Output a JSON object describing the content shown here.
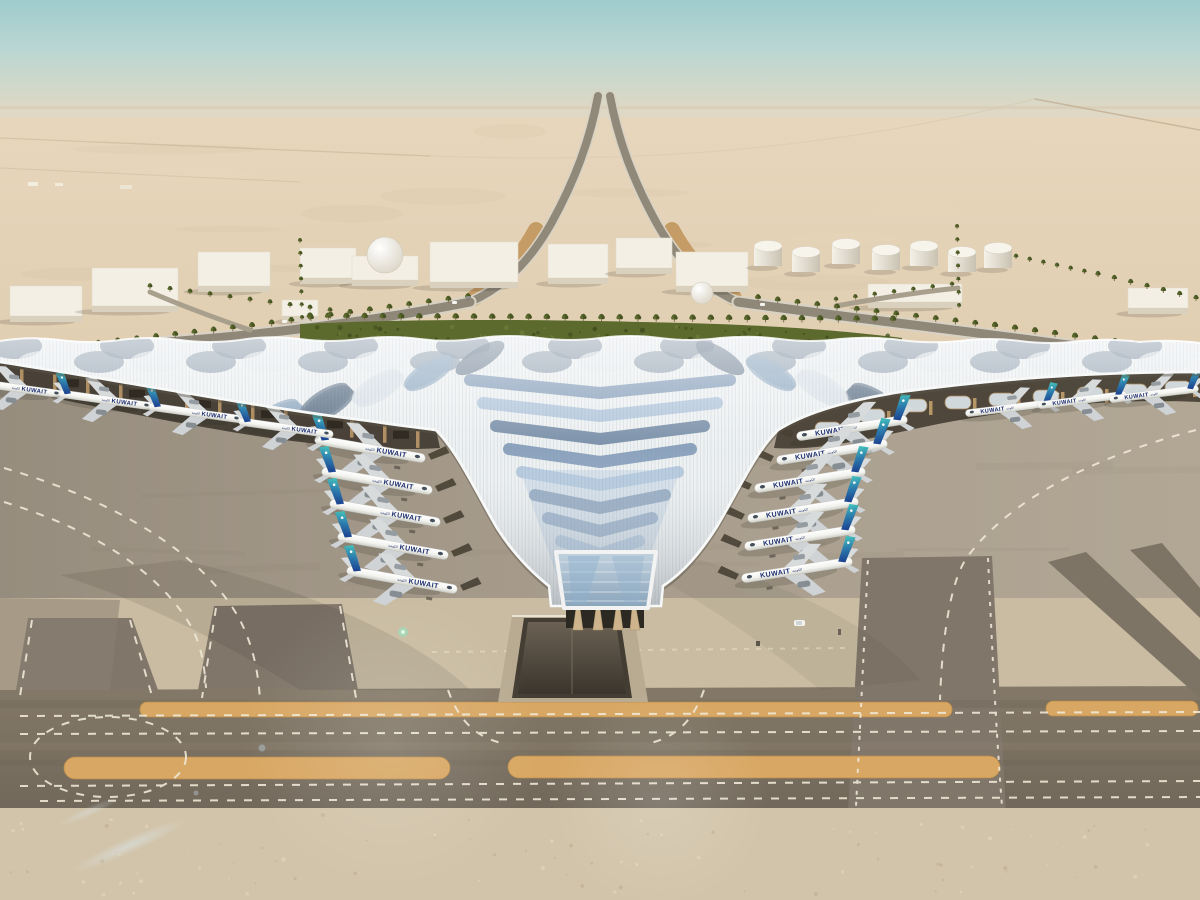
{
  "scene": {
    "subject": "aerial-rendering-airport-terminal",
    "livery": {
      "text": "KUWAIT",
      "arabic": "الكويتية"
    }
  },
  "colors": {
    "sky_top": "#9fcbce",
    "sky_mid": "#c2dad4",
    "sky_horizon": "#e7d8c2",
    "desert_far": "#e5d4ba",
    "desert_near": "#d6c3a4",
    "sand_pale": "#c9bca2",
    "sand_bottom": "#d2c4aa",
    "asphalt": "#7d7263",
    "apron": "#a89d8d",
    "tan_strip": "#d8a763",
    "marking": "#efe8d6",
    "roof_white": "#eef1f2",
    "roof_slate": "#5d7286",
    "roof_blue": "#7390b0",
    "roof_blue_light": "#a6bfd8",
    "under_canopy": "#3e372d",
    "column_tan": "#c8a36e",
    "arch_glass": "#dfe8ee",
    "green": "#5c6a2e",
    "green_dark": "#46521f",
    "palm": "#4e5c28",
    "trunk": "#7a6a4a",
    "plane_white": "#f4f4f0",
    "plane_grey": "#d8dbdc",
    "engine": "#969da2",
    "tail_teal": "#46c4bc",
    "tail_mid": "#2d7fae",
    "tail_blue": "#1c3e8e",
    "livery_navy": "#1d2f70",
    "building_roof": "#f3efe4",
    "building_front": "#d9d0bd",
    "road": "#90897a",
    "road_light": "#d8d2c5",
    "trench_tan": "#c69c66",
    "shadow": "#3a342a"
  },
  "aircraft": {
    "left_column": {
      "dir": 1,
      "rot": 10,
      "s": 1.0,
      "bridge": true,
      "pts": [
        [
          370,
          449
        ],
        [
          377,
          481
        ],
        [
          385,
          513
        ],
        [
          393,
          546
        ],
        [
          402,
          580
        ]
      ]
    },
    "left_wing": {
      "dir": 1,
      "rot": 8,
      "s": 0.85,
      "bridge": false,
      "pts": [
        [
          16,
          388
        ],
        [
          106,
          400
        ],
        [
          196,
          413
        ],
        [
          286,
          428
        ]
      ]
    },
    "right_column": {
      "dir": -1,
      "rot": -9,
      "s": 1.0,
      "bridge": true,
      "pts": [
        [
          852,
          428
        ],
        [
          832,
          452
        ],
        [
          810,
          480
        ],
        [
          803,
          510
        ],
        [
          800,
          538
        ],
        [
          797,
          570
        ]
      ]
    },
    "right_wing": {
      "dir": -1,
      "rot": -7,
      "s": 0.8,
      "bridge": false,
      "pts": [
        [
          1010,
          408
        ],
        [
          1082,
          400
        ],
        [
          1154,
          394
        ]
      ]
    }
  },
  "fuel_tanks": [
    [
      768,
      246
    ],
    [
      806,
      252
    ],
    [
      846,
      244
    ],
    [
      886,
      250
    ],
    [
      924,
      246
    ],
    [
      962,
      252
    ],
    [
      998,
      248
    ]
  ],
  "buildings": [
    {
      "x": 10,
      "y": 286,
      "w": 72,
      "h": 30
    },
    {
      "x": 92,
      "y": 268,
      "w": 86,
      "h": 38
    },
    {
      "x": 198,
      "y": 252,
      "w": 72,
      "h": 34
    },
    {
      "x": 282,
      "y": 300,
      "w": 36,
      "h": 16
    },
    {
      "x": 300,
      "y": 248,
      "w": 56,
      "h": 30
    },
    {
      "x": 352,
      "y": 256,
      "w": 66,
      "h": 24,
      "dome": [
        385,
        255,
        18
      ]
    },
    {
      "x": 430,
      "y": 242,
      "w": 88,
      "h": 40
    },
    {
      "x": 548,
      "y": 244,
      "w": 60,
      "h": 34
    },
    {
      "x": 616,
      "y": 238,
      "w": 56,
      "h": 30
    },
    {
      "x": 676,
      "y": 252,
      "w": 72,
      "h": 34,
      "dome": [
        702,
        293,
        11
      ]
    },
    {
      "x": 868,
      "y": 284,
      "w": 94,
      "h": 18
    },
    {
      "x": 1128,
      "y": 288,
      "w": 60,
      "h": 20
    }
  ],
  "palm_rows": [
    {
      "x1": 310,
      "y1": 320,
      "x2": 893,
      "y2": 323,
      "n": 33,
      "s": 1.0
    },
    {
      "x1": 468,
      "y1": 300,
      "x2": 252,
      "y2": 329,
      "n": 12,
      "s": 0.9
    },
    {
      "x1": 252,
      "y1": 329,
      "x2": 60,
      "y2": 351,
      "n": 11,
      "s": 0.9
    },
    {
      "x1": 150,
      "y1": 289,
      "x2": 330,
      "y2": 313,
      "n": 10,
      "s": 0.75
    },
    {
      "x1": 758,
      "y1": 301,
      "x2": 995,
      "y2": 329,
      "n": 13,
      "s": 0.9
    },
    {
      "x1": 995,
      "y1": 329,
      "x2": 1195,
      "y2": 356,
      "n": 11,
      "s": 0.95
    },
    {
      "x1": 1016,
      "y1": 259,
      "x2": 1098,
      "y2": 277,
      "n": 7,
      "s": 0.7
    },
    {
      "x1": 1098,
      "y1": 277,
      "x2": 1196,
      "y2": 301,
      "n": 7,
      "s": 0.8
    },
    {
      "x1": 300,
      "y1": 243,
      "x2": 302,
      "y2": 320,
      "n": 7,
      "s": 0.65
    },
    {
      "x1": 957,
      "y1": 229,
      "x2": 959,
      "y2": 308,
      "n": 7,
      "s": 0.65
    },
    {
      "x1": 836,
      "y1": 302,
      "x2": 952,
      "y2": 287,
      "n": 7,
      "s": 0.7
    }
  ],
  "roof_pattern": {
    "crest_row1": {
      "x0": 15,
      "dx": 56,
      "n": 22,
      "y": 346,
      "rx": 27,
      "ry": 13,
      "colors": [
        "#6c7e91",
        "#e9edf0"
      ]
    },
    "crest_row2": {
      "x0": 43,
      "dx": 56,
      "n": 21,
      "y": 362,
      "rx": 25,
      "ry": 11,
      "colors": [
        "#e9edf0",
        "#7d8fa1"
      ]
    },
    "chevrons": {
      "n": 9,
      "y0": 380,
      "dy": 23,
      "w0": 130,
      "dw": 13,
      "minw": 26,
      "colors": [
        "#7390b0",
        "#a6bfd8",
        "#5f7a98"
      ]
    },
    "leaf_colors": [
      "#5d7286",
      "#8fa9c2",
      "#dde3e9"
    ]
  },
  "under_canopy": {
    "left_columns_n": 13,
    "right_arches": [
      [
        1178,
        381
      ],
      [
        1134,
        384
      ],
      [
        1090,
        387
      ],
      [
        1046,
        390
      ],
      [
        1002,
        393
      ],
      [
        958,
        396
      ],
      [
        914,
        399
      ],
      [
        872,
        409
      ],
      [
        828,
        422
      ]
    ]
  },
  "ground_vehicles": [
    [
      794,
      620
    ],
    [
      756,
      641
    ],
    [
      838,
      629
    ]
  ],
  "seeds": {
    "desert": 7,
    "garden": 11,
    "speckle": 23,
    "apron": 5
  }
}
